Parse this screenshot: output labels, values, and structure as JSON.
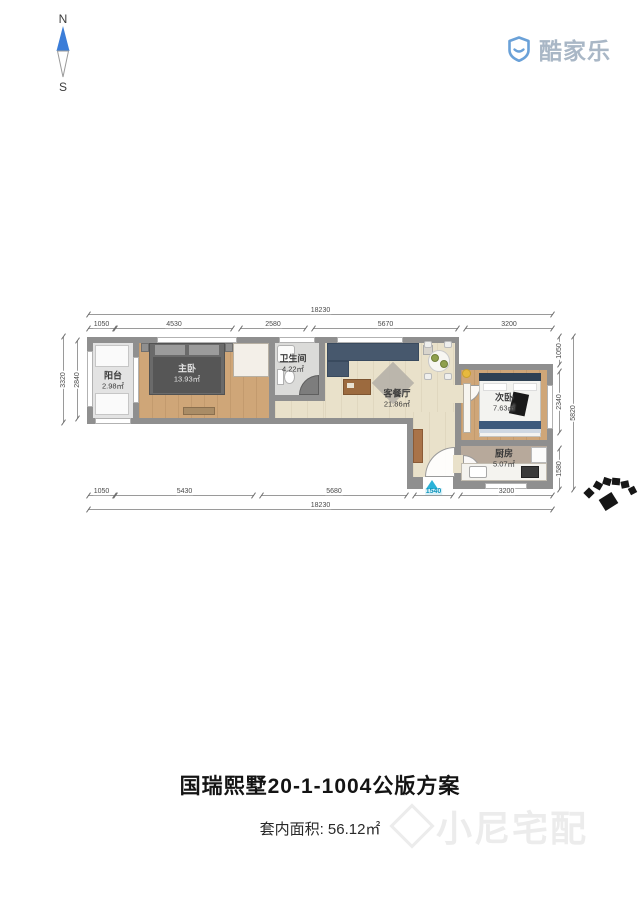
{
  "compass": {
    "north": "N",
    "south": "S"
  },
  "logo": {
    "brand": "酷家乐"
  },
  "plan": {
    "rooms": [
      {
        "name": "阳台",
        "area": "2.98㎡"
      },
      {
        "name": "主卧",
        "area": "13.93㎡"
      },
      {
        "name": "卫生间",
        "area": "4.22㎡"
      },
      {
        "name": "客餐厅",
        "area": "21.86㎡"
      },
      {
        "name": "次卧",
        "area": "7.63㎡"
      },
      {
        "name": "厨房",
        "area": "5.07㎡"
      }
    ],
    "dims": {
      "top_total": "18230",
      "top": [
        "1050",
        "4530",
        "2580",
        "5670",
        "3200"
      ],
      "bottom": [
        "1050",
        "5430",
        "5680",
        "1540",
        "3200"
      ],
      "bottom_total": "18230",
      "left": [
        "3320",
        "2840"
      ],
      "right": [
        "1050",
        "2340",
        "1580"
      ],
      "right_total": "5820"
    }
  },
  "footer": {
    "title": "国瑞熙墅20-1-1004公版方案",
    "area_label": "套内面积: 56.12㎡",
    "watermark": "小尼宅配"
  },
  "colors": {
    "accent": "#2bb3d9",
    "wall": "#8f8f8f",
    "brand_blue": "#5f9bd8"
  }
}
